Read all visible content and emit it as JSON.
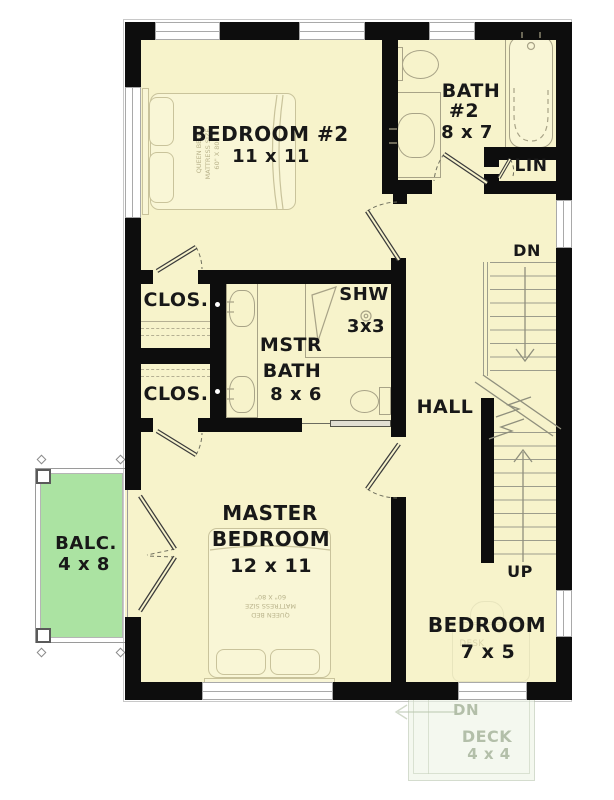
{
  "colors": {
    "wall": "#0d0d0d",
    "floor": "#f7f3cb",
    "balcony_fill": "#abe3a2",
    "deck_fill": "#eef5e6",
    "furniture_line": "#c9c39b",
    "fixture_line": "#a8a387",
    "text": "#181818"
  },
  "rooms": {
    "bedroom2": {
      "label": "BEDROOM #2",
      "dims": "11 x 11"
    },
    "bath2": {
      "line1": "BATH",
      "line2": "#2",
      "dims": "8 x 7"
    },
    "linen": {
      "label": "LIN"
    },
    "closet1": {
      "label": "CLOS."
    },
    "closet2": {
      "label": "CLOS."
    },
    "master_bath": {
      "line1": "MSTR",
      "line2": "BATH",
      "dims": "8 x 6"
    },
    "shower": {
      "label": "SHW",
      "dims": "3x3"
    },
    "hall": {
      "label": "HALL"
    },
    "master_bedroom": {
      "line1": "MASTER",
      "line2": "BEDROOM",
      "dims": "12 x 11"
    },
    "bedroom3": {
      "label": "BEDROOM",
      "dims": "7 x 5"
    },
    "balcony": {
      "label": "BALC.",
      "dims": "4 x 8"
    },
    "deck": {
      "label": "DECK",
      "dims": "4 x 4",
      "down": "DN"
    }
  },
  "stairs": {
    "down": "DN",
    "up": "UP"
  },
  "furniture": {
    "bed_note": {
      "line1": "QUEEN BED",
      "line2": "MATTRESS SIZE",
      "line3": "60\" X 80\""
    },
    "desk_label": "DESK"
  }
}
